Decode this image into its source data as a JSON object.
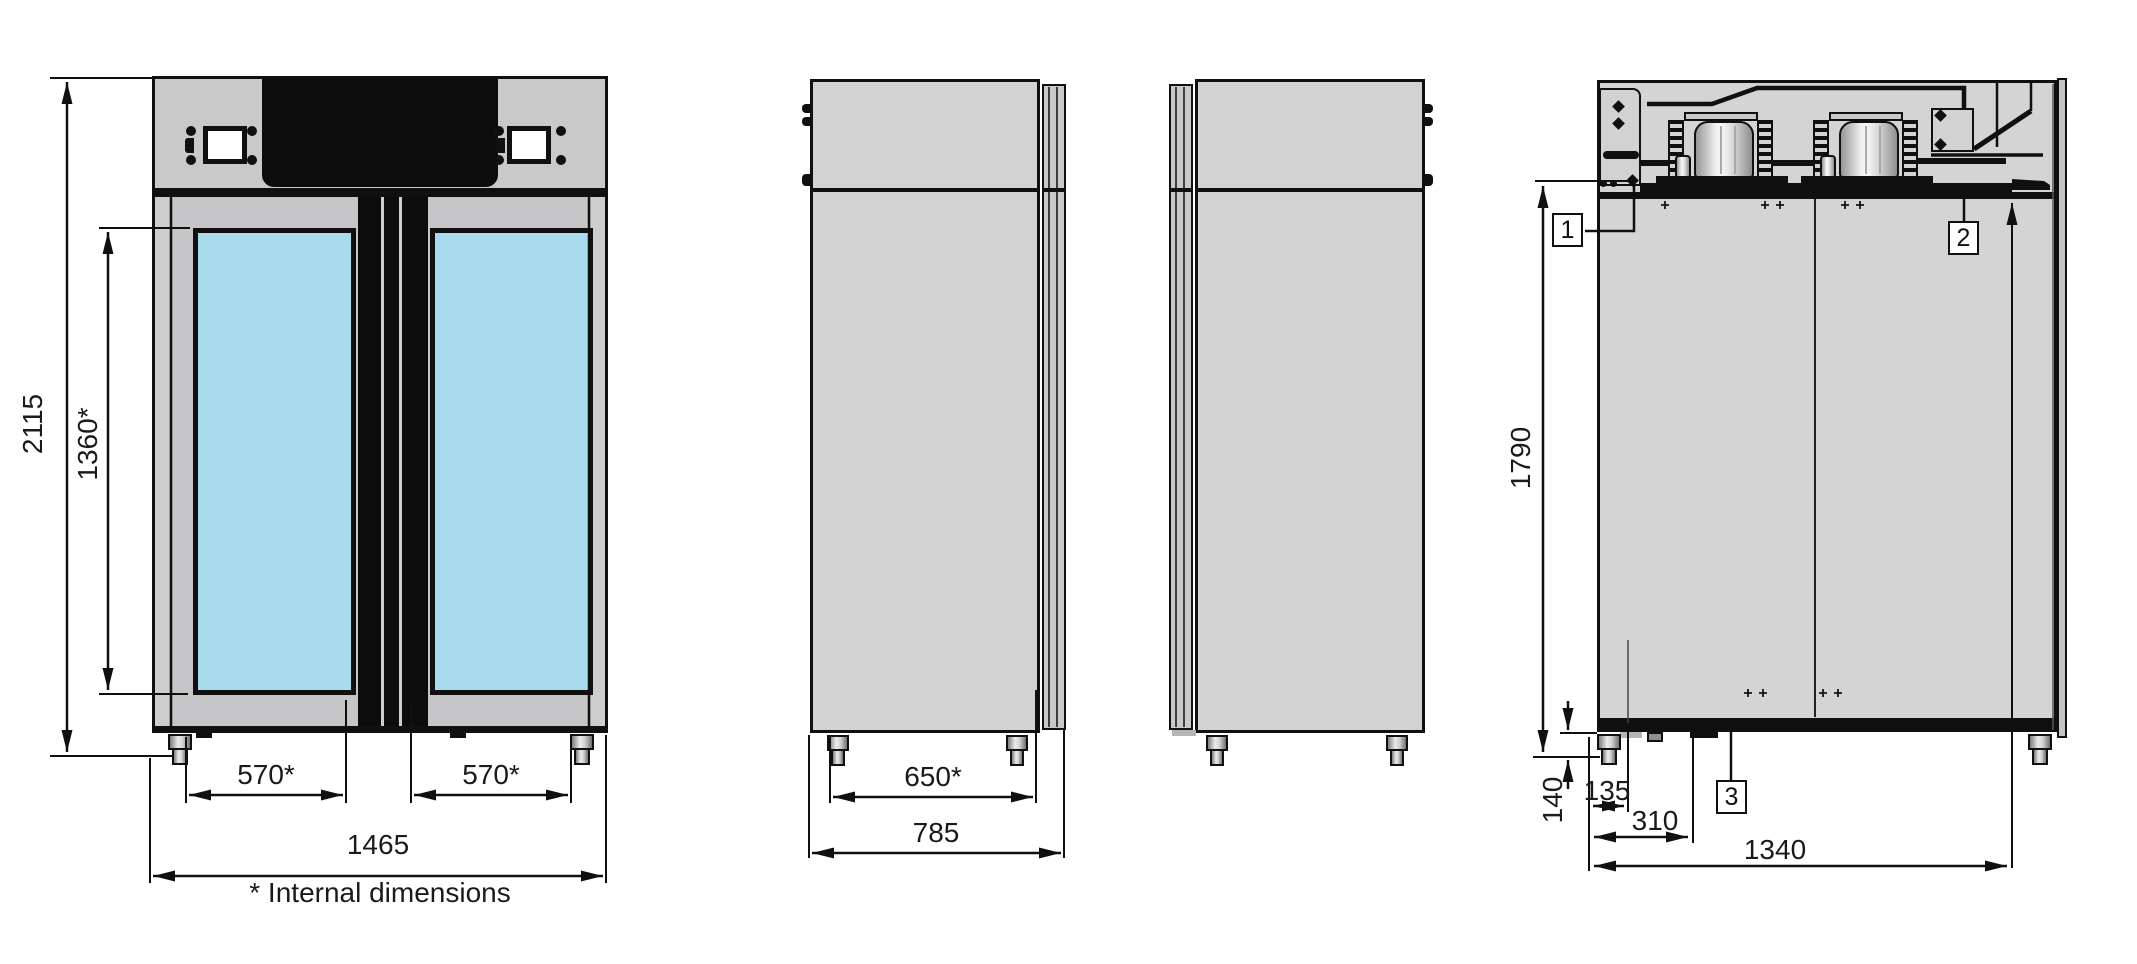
{
  "note": {
    "text": "* Internal dimensions"
  },
  "dimensions": {
    "front": {
      "overall_height": "2115",
      "internal_height": "1360*",
      "internal_width_left": "570*",
      "internal_width_right": "570*",
      "overall_width": "1465"
    },
    "side": {
      "internal_depth": "650*",
      "overall_depth": "785"
    },
    "rear": {
      "height": "1790",
      "foot_height": "140",
      "offset_small": "135",
      "offset_mid": "310",
      "width": "1340"
    }
  },
  "callouts": [
    {
      "label": "1"
    },
    {
      "label": "2"
    },
    {
      "label": "3"
    }
  ],
  "colors": {
    "glass_blue": "#a7dbec",
    "panel_gray": "#cdcdce",
    "line_black": "#101010",
    "background": "#ffffff"
  }
}
